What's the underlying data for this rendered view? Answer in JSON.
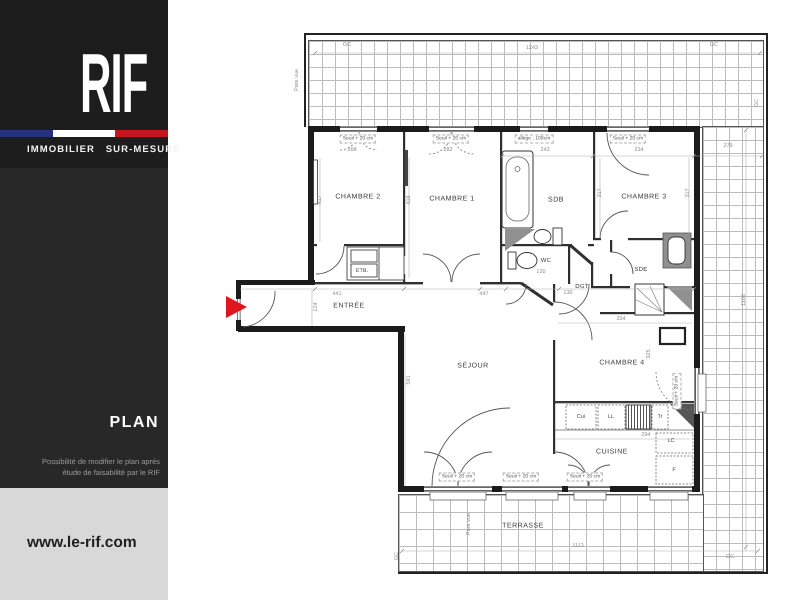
{
  "sidebar": {
    "brand": "RIF",
    "tagline": "IMMOBILIER SUR-MESURE",
    "section_title": "PLAN",
    "note_line1": "Possibilité de modifier le plan après",
    "note_line2": "étude de faisabilité par le RIF",
    "website": "www.le-rif.com"
  },
  "colors": {
    "sidebar_bg": "#282828",
    "logo_bg": "#1d1d1d",
    "flag_blue": "#26317e",
    "flag_white": "#ffffff",
    "flag_red": "#c51422",
    "footer_bg": "#d8d8d8",
    "arrow_red": "#e0161e",
    "wall_color": "#1b1b1b"
  },
  "plan": {
    "rooms": [
      {
        "label": "CHAMBRE 2",
        "x": 358,
        "y": 197
      },
      {
        "label": "CHAMBRE 1",
        "x": 452,
        "y": 199
      },
      {
        "label": "SDB",
        "x": 556,
        "y": 200
      },
      {
        "label": "CHAMBRE 3",
        "x": 644,
        "y": 197
      },
      {
        "label": "ENTRÉE",
        "x": 349,
        "y": 306
      },
      {
        "label": "SÉJOUR",
        "x": 473,
        "y": 366
      },
      {
        "label": "CHAMBRE 4",
        "x": 622,
        "y": 363
      },
      {
        "label": "CUISINE",
        "x": 612,
        "y": 452
      },
      {
        "label": "TERRASSE",
        "x": 523,
        "y": 526
      },
      {
        "label": "WC",
        "x": 546,
        "y": 261,
        "small": true
      },
      {
        "label": "DGT",
        "x": 582,
        "y": 287,
        "small": true
      },
      {
        "label": "SDE",
        "x": 641,
        "y": 270,
        "small": true
      }
    ],
    "appliances": [
      {
        "label": "Cui",
        "x": 581,
        "y": 417
      },
      {
        "label": "LL",
        "x": 611,
        "y": 417
      },
      {
        "label": "Tr",
        "x": 660,
        "y": 417
      },
      {
        "label": "LC",
        "x": 671,
        "y": 441
      },
      {
        "label": "F",
        "x": 674,
        "y": 470
      },
      {
        "label": "ETB.",
        "x": 362,
        "y": 271
      }
    ],
    "dims": [
      {
        "text": "1243",
        "x": 532,
        "y": 48
      },
      {
        "text": "GC",
        "x": 347,
        "y": 45
      },
      {
        "text": "GC",
        "x": 714,
        "y": 45
      },
      {
        "text": "GC",
        "x": 757,
        "y": 103,
        "rot": true
      },
      {
        "text": "Pare vue",
        "x": 297,
        "y": 80,
        "rot": true
      },
      {
        "text": "279",
        "x": 728,
        "y": 146
      },
      {
        "text": "243",
        "x": 545,
        "y": 150
      },
      {
        "text": "234",
        "x": 639,
        "y": 150
      },
      {
        "text": "268",
        "x": 352,
        "y": 150
      },
      {
        "text": "282",
        "x": 448,
        "y": 150
      },
      {
        "text": "417",
        "x": 320,
        "y": 200,
        "rot": true
      },
      {
        "text": "418",
        "x": 409,
        "y": 200,
        "rot": true
      },
      {
        "text": "317",
        "x": 600,
        "y": 193,
        "rot": true
      },
      {
        "text": "317",
        "x": 688,
        "y": 193,
        "rot": true
      },
      {
        "text": "441",
        "x": 337,
        "y": 294
      },
      {
        "text": "447",
        "x": 484,
        "y": 294
      },
      {
        "text": "120",
        "x": 541,
        "y": 272
      },
      {
        "text": "130",
        "x": 568,
        "y": 293
      },
      {
        "text": "124",
        "x": 316,
        "y": 307,
        "rot": true
      },
      {
        "text": "591",
        "x": 409,
        "y": 380,
        "rot": true
      },
      {
        "text": "354",
        "x": 621,
        "y": 319
      },
      {
        "text": "325",
        "x": 649,
        "y": 354,
        "rot": true
      },
      {
        "text": "294",
        "x": 646,
        "y": 435
      },
      {
        "text": "1108",
        "x": 744,
        "y": 300,
        "rot": true
      },
      {
        "text": "1113",
        "x": 578,
        "y": 546
      },
      {
        "text": "Pare vue",
        "x": 469,
        "y": 524,
        "rot": true
      },
      {
        "text": "GC",
        "x": 397,
        "y": 556,
        "rot": true
      },
      {
        "text": "GC",
        "x": 730,
        "y": 557
      }
    ],
    "seuils": [
      {
        "text": "Seuil + 20 cm",
        "x": 358,
        "y": 139
      },
      {
        "text": "Seuil + 20 cm",
        "x": 451,
        "y": 139
      },
      {
        "text": "allège : 100cm",
        "x": 534,
        "y": 139
      },
      {
        "text": "Seuil + 20 cm",
        "x": 628,
        "y": 139
      },
      {
        "text": "Seuil + 20 cm",
        "x": 457,
        "y": 477
      },
      {
        "text": "Seuil + 20 cm",
        "x": 521,
        "y": 477
      },
      {
        "text": "Seuil + 20 cm",
        "x": 585,
        "y": 477
      },
      {
        "text": "Seuil + 20 cm",
        "x": 677,
        "y": 391,
        "rot": true
      }
    ]
  }
}
